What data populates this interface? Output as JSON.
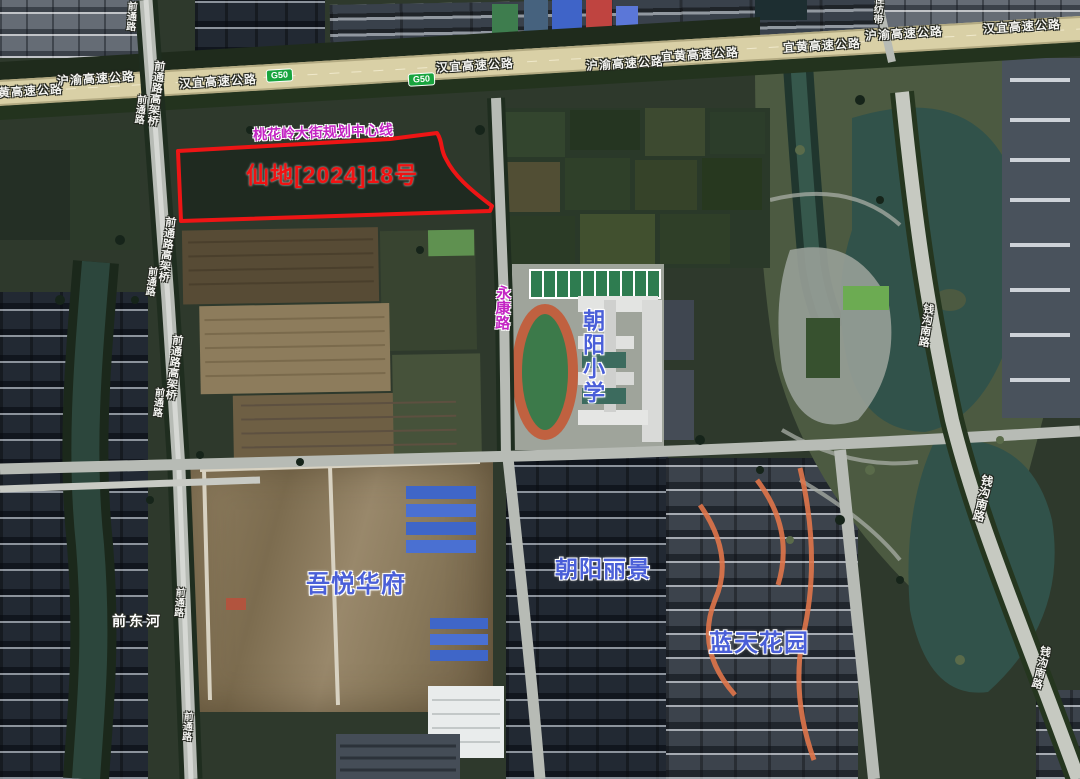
{
  "map_labels": {
    "parcel_label": "仙地[2024]18号",
    "planning_line": "桃花岭大街规划中心线",
    "badge": "G50",
    "highways": [
      "黄高速公路",
      "沪渝高速公路",
      "汉宜高速公路",
      "汉宜高速公路",
      "沪渝高速公路",
      "宜黄高速公路",
      "宜黄高速公路",
      "沪渝高速公路",
      "汉宜高速公路"
    ],
    "roads": [
      "前通路",
      "前通路高架桥",
      "前通路",
      "前通路高架桥",
      "前通路",
      "前通路高架桥",
      "前通路",
      "前通路",
      "前通路",
      "钱沟南路",
      "钱沟南路",
      "钱沟南路",
      "佳纺带"
    ],
    "streets": [
      "永康路"
    ],
    "places": [
      "朝阳小学",
      "吾悦华府",
      "朝阳丽景",
      "蓝天花园"
    ],
    "water": [
      "前东河"
    ]
  },
  "colors": {
    "parcel_outline": "#ee1515",
    "parcel_text": "#f01212",
    "planning_text": "#c324c3",
    "place_text": "#4a5fd8",
    "street_text": "#c324c3",
    "badge_bg": "#18a43e",
    "road_text": "#f4f4f1"
  }
}
